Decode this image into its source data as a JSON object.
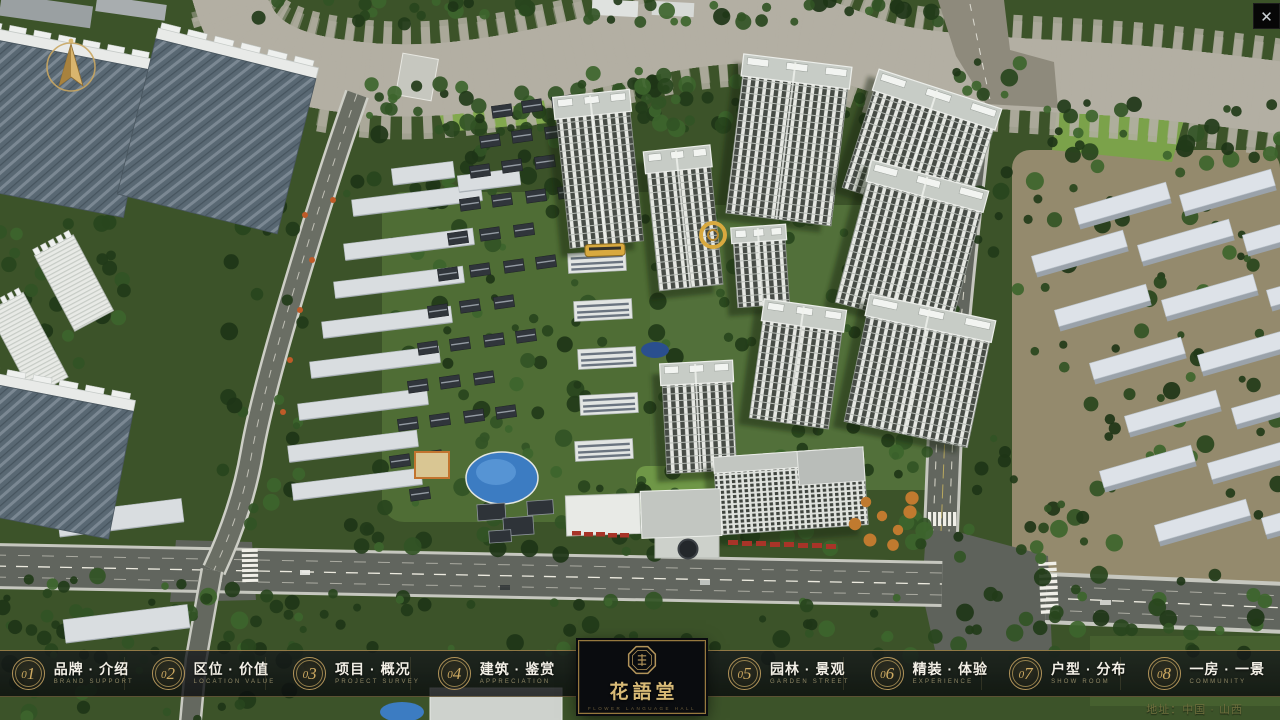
{
  "window": {
    "close_glyph": "✕"
  },
  "nav": {
    "items_left": [
      {
        "num": "01",
        "label": "品牌 · 介绍",
        "sub": "BRAND SUPPORT"
      },
      {
        "num": "02",
        "label": "区位 · 价值",
        "sub": "LOCATION VALUE"
      },
      {
        "num": "03",
        "label": "项目 · 概况",
        "sub": "PROJECT SURVEY"
      },
      {
        "num": "04",
        "label": "建筑 · 鉴赏",
        "sub": "APPRECIATION"
      }
    ],
    "items_right": [
      {
        "num": "05",
        "label": "园林 · 景观",
        "sub": "GARDEN STREET"
      },
      {
        "num": "06",
        "label": "精装 · 体验",
        "sub": "EXPERIENCE"
      },
      {
        "num": "07",
        "label": "户型 · 分布",
        "sub": "SHOW ROOM"
      },
      {
        "num": "08",
        "label": "一房 · 一景",
        "sub": "COMMUNITY"
      }
    ]
  },
  "logo": {
    "title": "花語堂",
    "subtitle": "FLOWER LANGUAGE HALL"
  },
  "footer": {
    "address": "地址：中国 · 山西"
  },
  "colors": {
    "gold": "#b2945a",
    "bar_bg": "#0a0c0f",
    "river": "#2e62ba",
    "accent_red": "#a83428"
  }
}
